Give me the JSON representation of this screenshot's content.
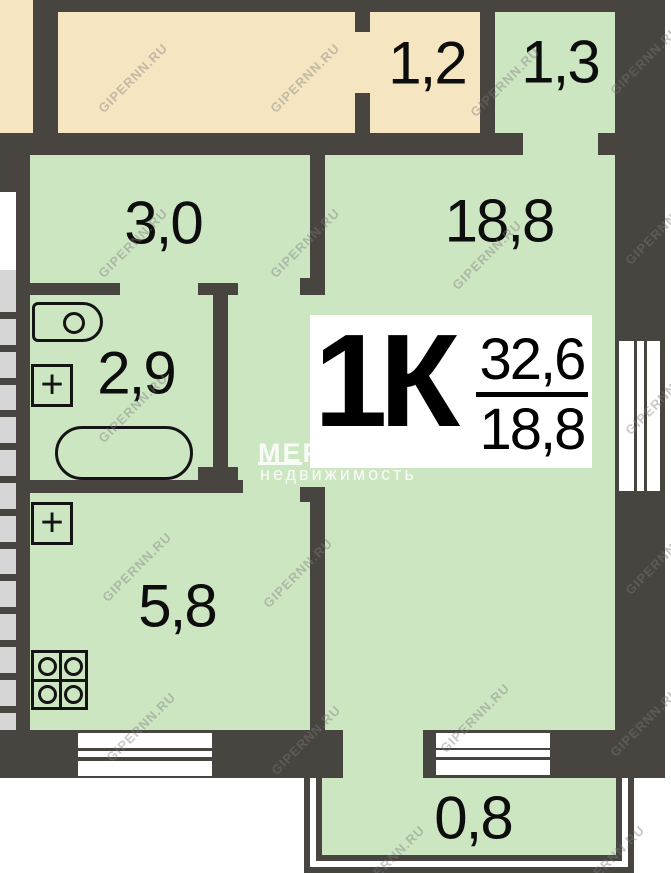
{
  "plan_title": "1K apartment floor plan",
  "badge": {
    "type": "1К",
    "area_total": "32,6",
    "area_living": "18,8"
  },
  "rooms": [
    {
      "name": "storage",
      "label": "1,2"
    },
    {
      "name": "closet",
      "label": "1,3"
    },
    {
      "name": "hallway",
      "label": "3,0"
    },
    {
      "name": "bathroom",
      "label": "2,9"
    },
    {
      "name": "kitchen",
      "label": "5,8"
    },
    {
      "name": "living-room",
      "label": "18,8"
    },
    {
      "name": "balcony",
      "label": "0,8"
    }
  ],
  "watermarks": {
    "site": {
      "text": "GIPERNN.RU",
      "positions": [
        [
          133,
          78
        ],
        [
          305,
          78
        ],
        [
          505,
          82
        ],
        [
          645,
          60
        ],
        [
          133,
          243
        ],
        [
          305,
          243
        ],
        [
          487,
          255
        ],
        [
          660,
          230
        ],
        [
          133,
          408
        ],
        [
          660,
          400
        ],
        [
          137,
          567
        ],
        [
          298,
          573
        ],
        [
          660,
          560
        ],
        [
          141,
          727
        ],
        [
          306,
          740
        ],
        [
          475,
          718
        ],
        [
          645,
          722
        ],
        [
          390,
          860
        ],
        [
          610,
          860
        ]
      ]
    },
    "agency": {
      "name": "МЕРИДИАН",
      "subtitle": "недвижимость"
    }
  },
  "colors": {
    "wall": "#48443f",
    "room_green": "#cde6c2",
    "corridor_beige": "#f6e5c1",
    "stair_gray": "#d6d6d6",
    "background": "#ffffff"
  }
}
